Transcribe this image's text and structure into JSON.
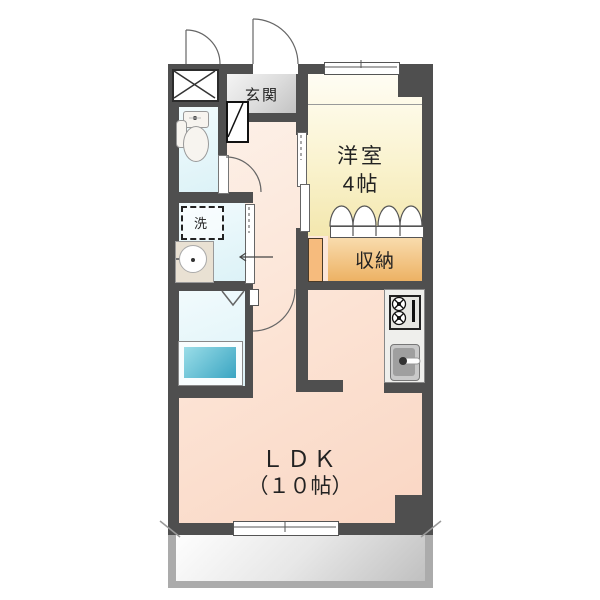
{
  "floorplan": {
    "labels": {
      "genkan": "玄関",
      "western_room_name": "洋室",
      "western_room_size": "4帖",
      "storage": "収納",
      "laundry": "洗",
      "ldk_name": "ＬＤＫ",
      "ldk_size": "（１０帖）"
    },
    "colors": {
      "wall": "#4f4f4f",
      "ldk_floor": "#fbdccb",
      "western_floor": "#f3e7ae",
      "storage": "#edb264",
      "water_rooms": "#dcf2f7",
      "bathtub": "#3aa5c2",
      "genkan_floor": "#c9c9c9",
      "balcony_frame": "#ababab",
      "closet_column": "#f6bb7d"
    }
  }
}
